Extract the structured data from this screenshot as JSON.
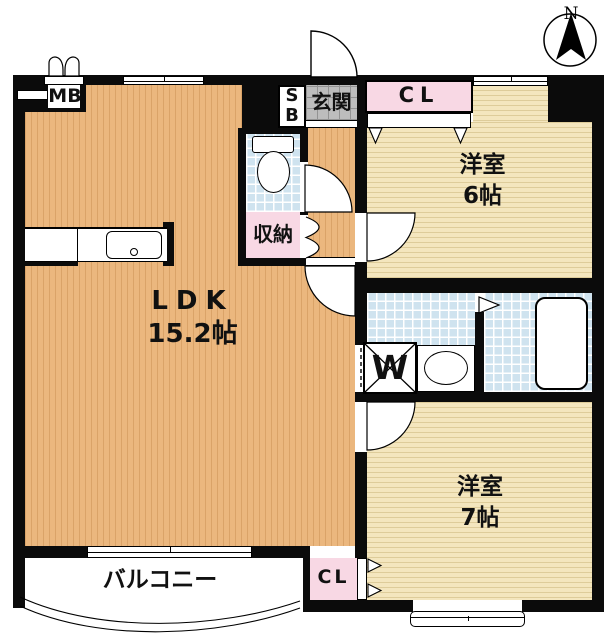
{
  "compass": {
    "north": "N"
  },
  "labels": {
    "meter_box": "MB",
    "shoe_box_top": "S",
    "shoe_box_bottom": "B",
    "entrance": "玄関",
    "closet_upper": "CL",
    "closet_lower": "CL",
    "storage": "収納",
    "washer": "W",
    "balcony": "バルコニー",
    "ldk_name": "LDK",
    "ldk_size": "15.2帖",
    "room6_name": "洋室",
    "room6_size": "6帖",
    "room7_name": "洋室",
    "room7_size": "7帖"
  },
  "colors": {
    "wall": "#0b0b0b",
    "ldk_floor": "#ebb77e",
    "bedroom_floor": "#f4e6be",
    "tile_floor": "#cfe3ef",
    "entrance_floor": "#bdbdbd",
    "closet_pink": "#f8d8e4"
  }
}
